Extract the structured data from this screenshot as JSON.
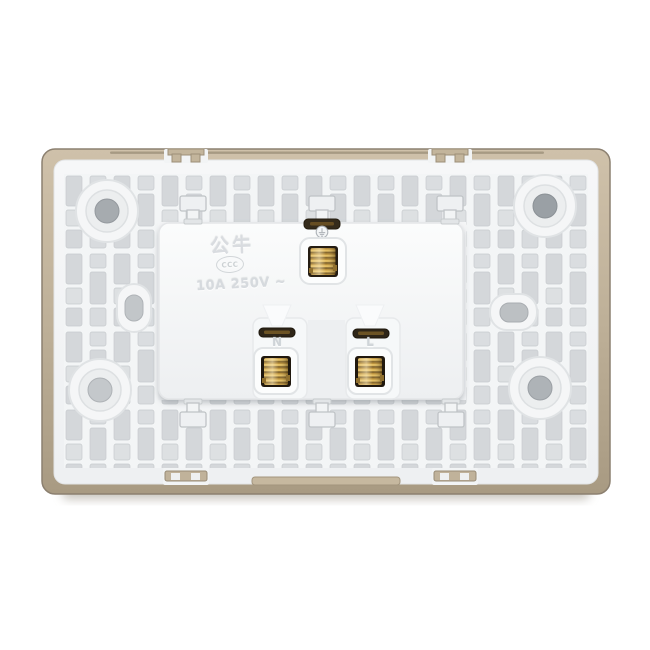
{
  "product": {
    "brand": "公牛",
    "certification_mark": "CCC",
    "rating": "10A 250V ~",
    "terminals": {
      "earth_symbol_icon": "earth-ground-icon",
      "neutral_label": "N",
      "live_label": "L"
    }
  },
  "colors": {
    "background": "#ffffff",
    "frame_champagne": "#b8a991",
    "back_plate_white": "#f3f5f6",
    "lattice_recess_gray": "#d5d8db",
    "module_white": "#f6f8f9",
    "terminal_cavity_dark": "#241c12",
    "brass_screw": "#c49a38",
    "embossed_text": "#d9dce0"
  }
}
